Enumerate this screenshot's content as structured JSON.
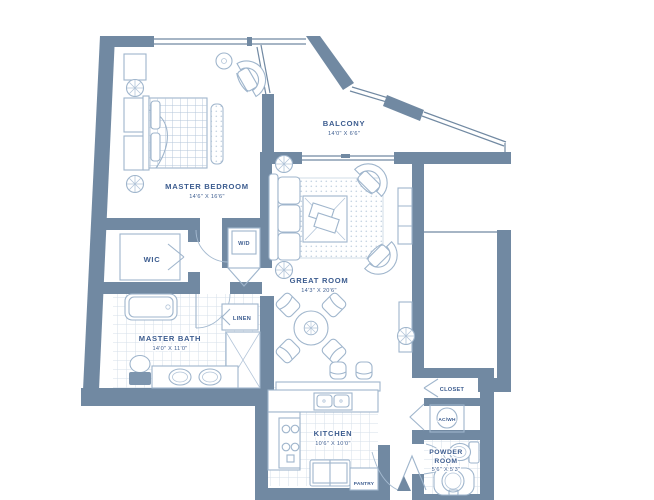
{
  "colors": {
    "wall": "#7189a2",
    "furniture_line": "#9fb5cc",
    "text": "#3c5c8f",
    "tile_line": "#d3dde9",
    "background": "#ffffff"
  },
  "rooms": {
    "master_bedroom": {
      "name": "MASTER BEDROOM",
      "dims": "14'6\" X 16'6\""
    },
    "balcony": {
      "name": "BALCONY",
      "dims": "14'0\" X 6'6\""
    },
    "great_room": {
      "name": "GREAT ROOM",
      "dims": "14'3\" X 20'6\""
    },
    "wic": {
      "name": "WIC"
    },
    "master_bath": {
      "name": "MASTER BATH",
      "dims": "14'0\" X 11'0\""
    },
    "kitchen": {
      "name": "KITCHEN",
      "dims": "10'6\" X 10'0\""
    },
    "powder_room": {
      "line1": "POWDER",
      "line2": "ROOM",
      "dims": "5'6\" X 5'3\""
    },
    "laundry": {
      "name": "W/D"
    },
    "linen": {
      "name": "LINEN"
    },
    "pantry": {
      "name": "PANTRY"
    },
    "closet": {
      "name": "CLOSET"
    },
    "ac_wh": {
      "name": "AC/WH"
    }
  }
}
